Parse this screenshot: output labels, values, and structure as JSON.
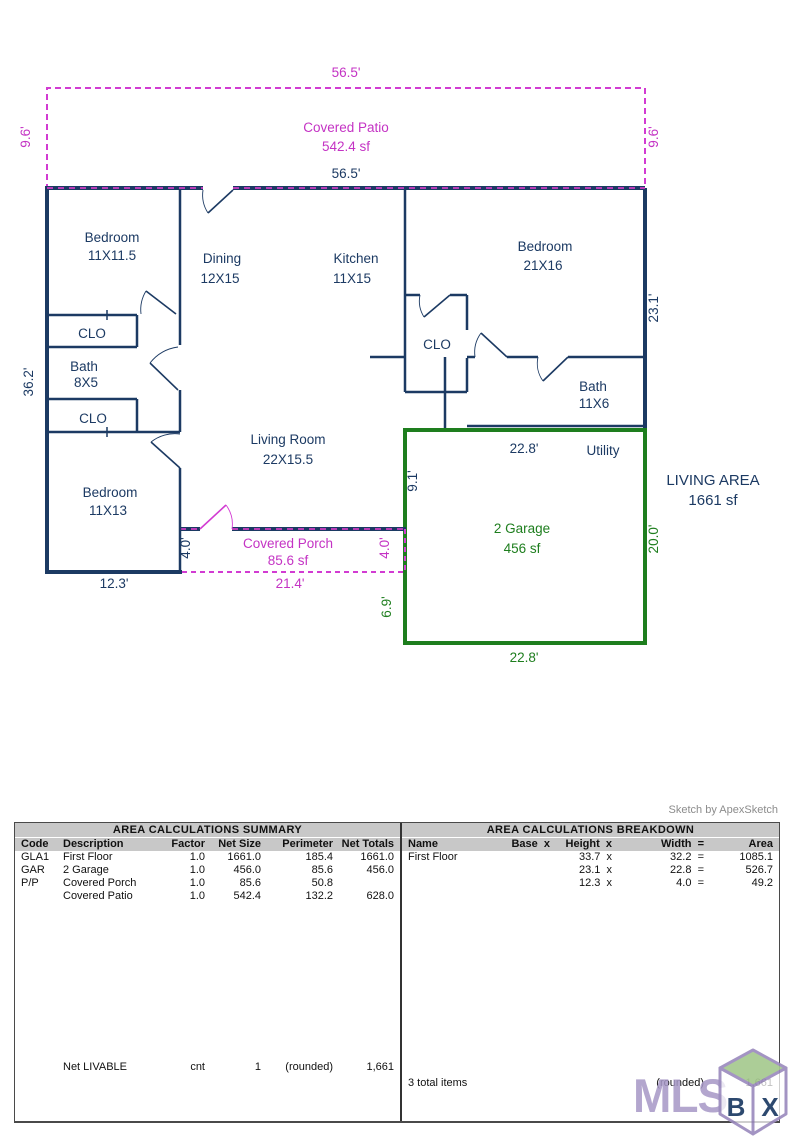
{
  "plan": {
    "patio_dim_top": "56.5'",
    "patio_side_dim": "9.6'",
    "patio_name": "Covered Patio",
    "patio_area": "542.4 sf",
    "house_width_dim": "56.5'",
    "bedroom1_name": "Bedroom",
    "bedroom1_size": "11X11.5",
    "dining_name": "Dining",
    "dining_size": "12X15",
    "kitchen_name": "Kitchen",
    "kitchen_size": "11X15",
    "bedroom2_name": "Bedroom",
    "bedroom2_size": "21X16",
    "clo1": "CLO",
    "bath1_name": "Bath",
    "bath1_size": "8X5",
    "clo2": "CLO",
    "bedroom3_name": "Bedroom",
    "bedroom3_size": "11X13",
    "clo3": "CLO",
    "bath2_name": "Bath",
    "bath2_size": "11X6",
    "living_name": "Living Room",
    "living_size": "22X15.5",
    "utility_name": "Utility",
    "garage_name": "2 Garage",
    "garage_area": "456 sf",
    "porch_name": "Covered Porch",
    "porch_area": "85.6 sf",
    "dim_left": "36.2'",
    "dim_right": "23.1'",
    "dim_bottom_left": "12.3'",
    "dim_porch_bottom": "21.4'",
    "dim_porch_left": "4.0'",
    "dim_porch_right": "4.0'",
    "dim_garage_left_upper": "9.1'",
    "dim_garage_left_lower": "6.9'",
    "dim_garage_right": "20.0'",
    "dim_garage_top": "22.8'",
    "dim_garage_bottom": "22.8'",
    "living_area_label": "LIVING AREA",
    "living_area_value": "1661 sf"
  },
  "summary": {
    "title": "AREA CALCULATIONS SUMMARY",
    "columns": [
      "Code",
      "Description",
      "Factor",
      "Net Size",
      "Perimeter",
      "Net Totals"
    ],
    "rows": [
      [
        "GLA1",
        "First Floor",
        "1.0",
        "1661.0",
        "185.4",
        "1661.0"
      ],
      [
        "GAR",
        "2 Garage",
        "1.0",
        "456.0",
        "85.6",
        "456.0"
      ],
      [
        "P/P",
        "Covered Porch",
        "1.0",
        "85.6",
        "50.8",
        ""
      ],
      [
        "",
        "Covered Patio",
        "1.0",
        "542.4",
        "132.2",
        "628.0"
      ]
    ],
    "footer": [
      "",
      "Net LIVABLE",
      "cnt",
      "1",
      "(rounded)",
      "1,661"
    ]
  },
  "breakdown": {
    "title": "AREA CALCULATIONS BREAKDOWN",
    "columns": [
      "Name",
      "Base  x",
      "Height  x",
      "Width  =",
      "Area"
    ],
    "rows": [
      [
        "First Floor",
        "",
        "33.7  x",
        "32.2  =",
        "1085.1"
      ],
      [
        "",
        "",
        "23.1  x",
        "22.8  =",
        "526.7"
      ],
      [
        "",
        "",
        "12.3  x",
        "4.0  =",
        "49.2"
      ]
    ],
    "footer_left": "3 total items",
    "footer_rounded": "(rounded)",
    "footer_total": "1,661"
  },
  "credit": "Sketch by ApexSketch",
  "watermark": {
    "text": "MLS",
    "cube_front": "B",
    "cube_side": "X"
  },
  "colors": {
    "wall_navy": "#1c3a63",
    "patio_magenta": "#c433c4",
    "garage_green": "#1e7e1e"
  }
}
